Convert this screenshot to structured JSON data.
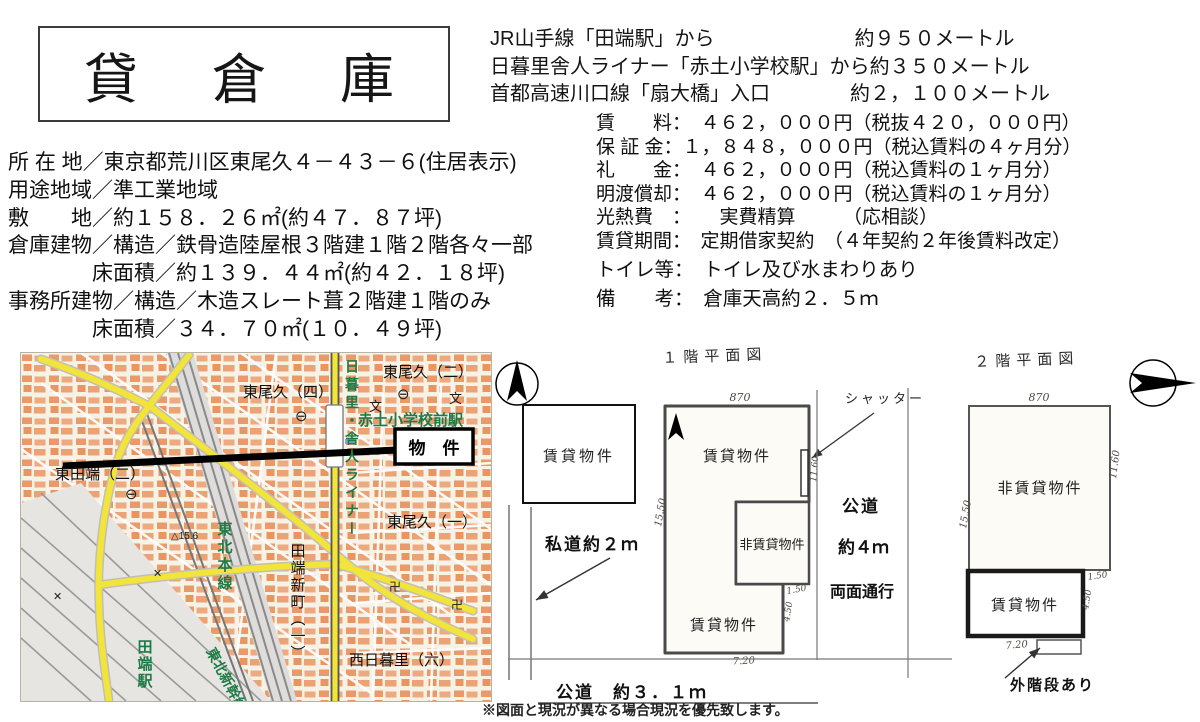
{
  "header": {
    "title": "貸　倉　庫"
  },
  "access": {
    "lines": [
      "JR山手線「田端駅」から　　　　　　　約９５０メートル",
      "日暮里舎人ライナー「赤土小学校駅」から約３５０メートル",
      "首都高速川口線「扇大橋」入口　　　　約２，１００メートル"
    ]
  },
  "property": {
    "lines": [
      "所 在 地／東京都荒川区東尾久４－４３－６(住居表示)",
      "用途地域／準工業地域",
      "敷　　地／約１５８．２６㎡(約４７．８７坪)",
      "倉庫建物／構造／鉄骨造陸屋根３階建１階２階各々一部",
      "　　　　床面積／約１３９．４４㎡(約４２．１８坪)",
      "事務所建物／構造／木造スレート葺２階建１階のみ",
      "　　　　床面積／３４．７０㎡(１０．４９坪)"
    ]
  },
  "terms": {
    "lines": [
      "賃　　料：　４６２，０００円（税抜４２０，０００円）",
      "保 証 金：１，８４８，０００円（税込賃料の４ヶ月分）",
      "礼　　金：　４６２，０００円（税込賃料の１ヶ月分）",
      "明渡償却：　４６２，０００円（税込賃料の１ヶ月分）",
      "光熱費　：　　実費精算　　　（応相談）",
      "賃貸期間：　定期借家契約　（４年契約２年後賃料改定）",
      "トイレ等：　トイレ及び水まわりあり",
      "備　　考：　倉庫天高約２．５ｍ"
    ]
  },
  "map": {
    "marker_label": "物　件",
    "labels": {
      "higashiogu4": "東尾久（四）",
      "higashiogu2": "東尾久（二）",
      "higashiogu1": "東尾久（一）",
      "higashitabata2": "東田端（二）",
      "nishinippori6": "西日暮里（六）",
      "tabatashinmachi1": "田端新町（一）",
      "akado_station": "赤土小学校前駅",
      "liner": "日暮里・舎人ライナー",
      "tohoku_line": "東北本線",
      "shinkansen": "東北新幹線",
      "tabata_station": "田端駅",
      "elevation": "△15.6"
    },
    "icons": {
      "school": "文",
      "temple": "卍",
      "police": "✕",
      "post": "⊖"
    }
  },
  "plans": {
    "plan1": {
      "title": "１階平面図",
      "office_label": "賃貸物件",
      "upper_label": "賃貸物件",
      "lower_label": "賃貸物件",
      "non_rental_label": "非賃貸物件",
      "shutter_label": "シャッター",
      "private_road_label": "私道約２ｍ",
      "road_right_1": "公道",
      "road_right_2": "約４ｍ",
      "road_right_3": "両面通行",
      "road_bottom": "公道　約３．１ｍ",
      "dims": {
        "top": "870",
        "left": "15.50",
        "right": "11.60",
        "inner": "1.50",
        "lower_right": "4.50",
        "bottom": "7.20"
      }
    },
    "plan2": {
      "title": "２階平面図",
      "non_rental_label": "非賃貸物件",
      "rental_label": "賃貸物件",
      "stair_label": "外階段あり",
      "dims": {
        "top": "870",
        "left": "15.50",
        "right": "11.60",
        "inner": "1.50",
        "lower_right": "4.50",
        "bottom": "7.20"
      }
    }
  },
  "footer": {
    "disclaimer": "※図面と現況が異なる場合現況を優先致します。"
  },
  "colors": {
    "road_yellow": "#f2e438",
    "block_orange": "#e9996a",
    "block_orange2": "#edaa80",
    "map_green": "#1e7a46",
    "ink": "#1a1a1a"
  }
}
